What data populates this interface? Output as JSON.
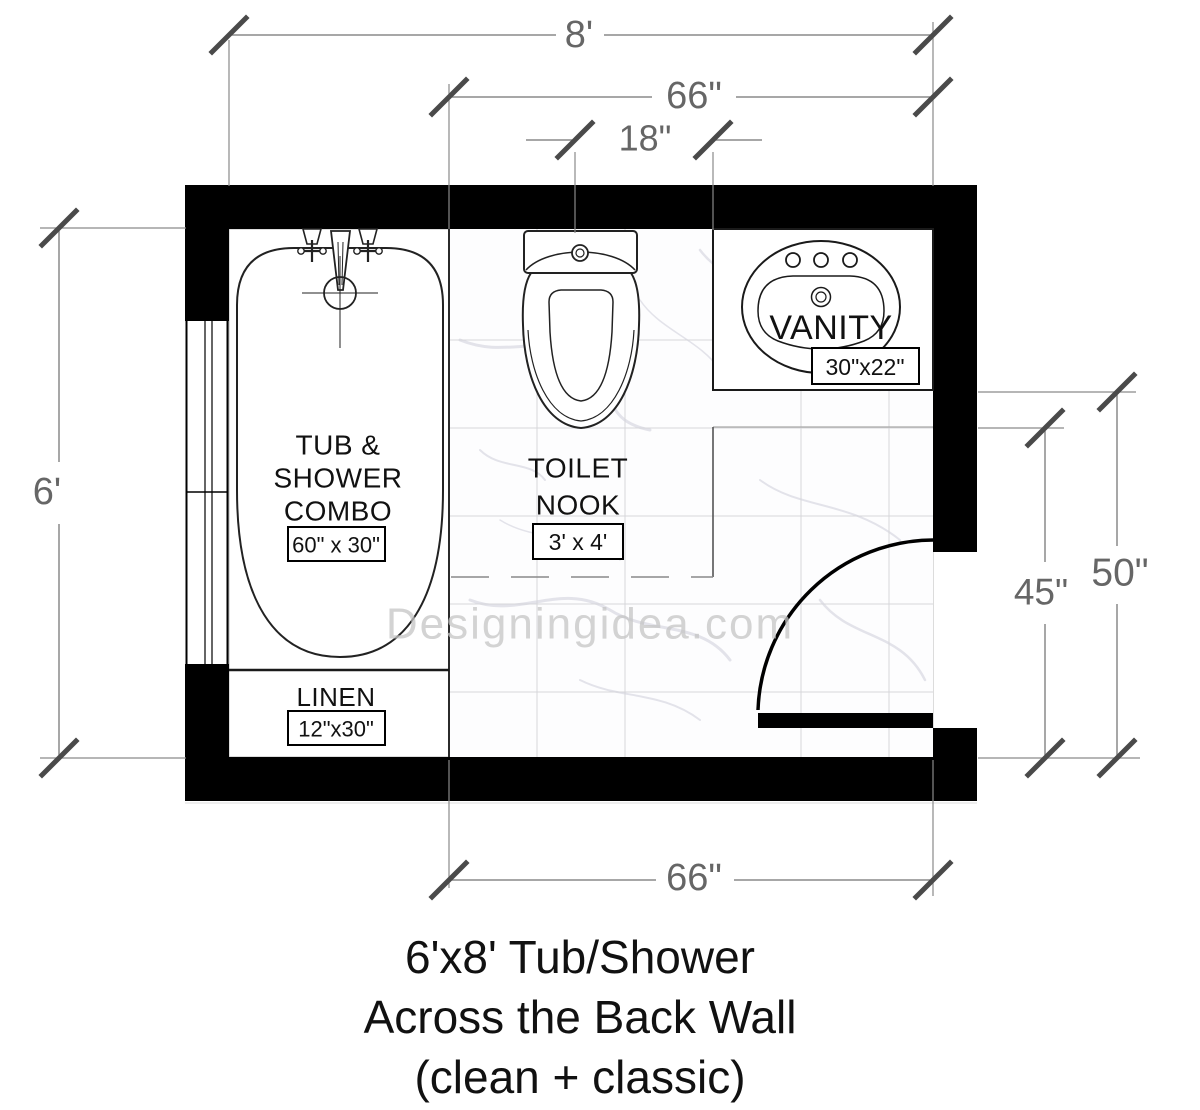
{
  "watermark": {
    "text": "Designingidea.com",
    "color": "#c5c5c5"
  },
  "title": {
    "line1": "6'x8' Tub/Shower",
    "line2": "Across the Back Wall",
    "line3": "(clean + classic)"
  },
  "dimensions": {
    "overall_width": "8'",
    "inner_width_top": "66\"",
    "toilet_centerline": "18\"",
    "overall_height": "6'",
    "right_clearance_inner": "45\"",
    "right_clearance_outer": "50\"",
    "inner_width_bottom": "66\""
  },
  "fixtures": {
    "tub_label_1": "TUB &",
    "tub_label_2": "SHOWER",
    "tub_label_3": "COMBO",
    "tub_size": "60\" x 30\"",
    "linen_label": "LINEN",
    "linen_size": "12\"x30\"",
    "nook_label_1": "TOILET",
    "nook_label_2": "NOOK",
    "nook_size": "3' x 4'",
    "vanity_label": "VANITY",
    "vanity_size": "30\"x22\""
  },
  "colors": {
    "wall": "#000000",
    "dim_line": "#8a8a8a",
    "dim_text": "#666666",
    "tick": "#4a4a4a",
    "label_text": "#111111",
    "tile_line": "#d6d6da",
    "watermark": "#c5c5c5"
  }
}
